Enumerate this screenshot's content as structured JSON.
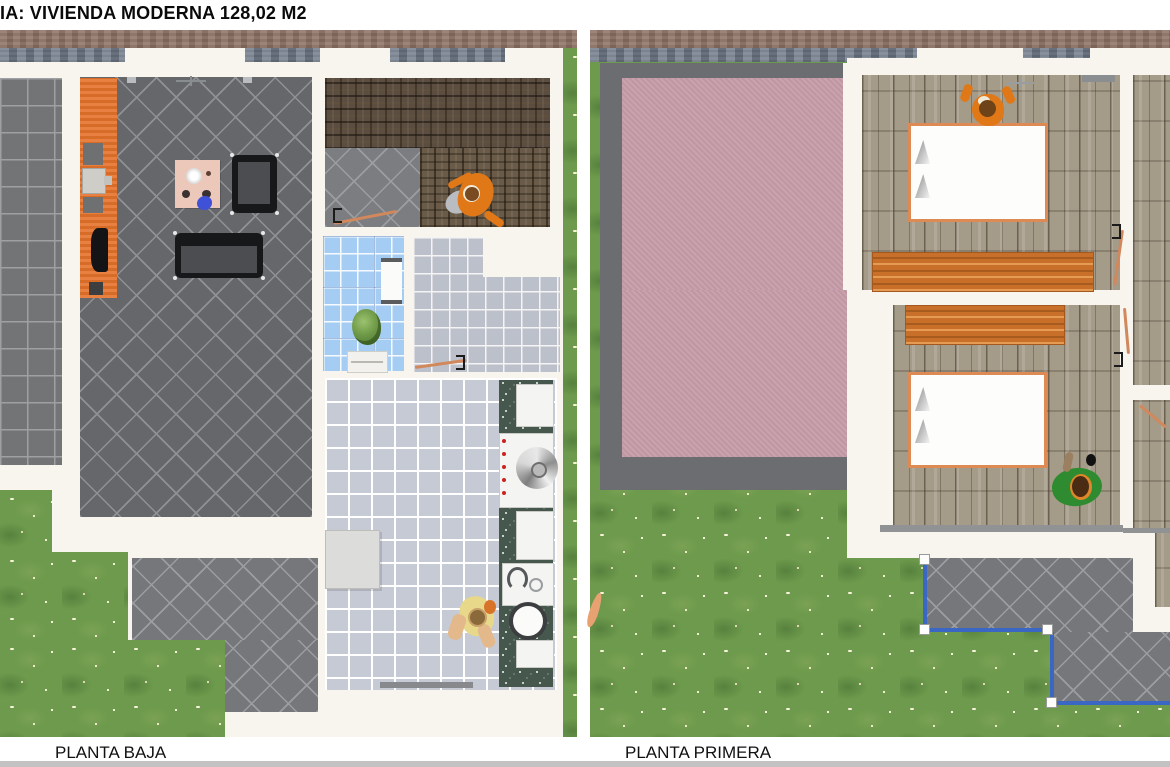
{
  "header": {
    "title": "IA: VIVIENDA MODERNA 128,02 M2"
  },
  "plans": {
    "left": {
      "label": "PLANTA BAJA"
    },
    "right": {
      "label": "PLANTA PRIMERA"
    }
  },
  "colors": {
    "accent_orange": "#E4722A",
    "roof_pink": "#C69DA9",
    "grass_green": "#6D9A4C",
    "balcony_blue": "#3A66C4",
    "bathroom_blue": "#A5CDF4",
    "entry_wood_brown": "#5B4D3F",
    "bedroom_plank_grey": "#A59B89",
    "dark_tile_grey": "#65676A",
    "kitchen_tile_grey": "#C6CAD5",
    "counter_green": "#46584E",
    "wall_white": "#F8F5EE",
    "street_band_brown": "#8F7466",
    "pavement_band_grey": "#75808D",
    "bed_frame_orange": "#DD8A55",
    "sofa_black": "#17181A"
  }
}
